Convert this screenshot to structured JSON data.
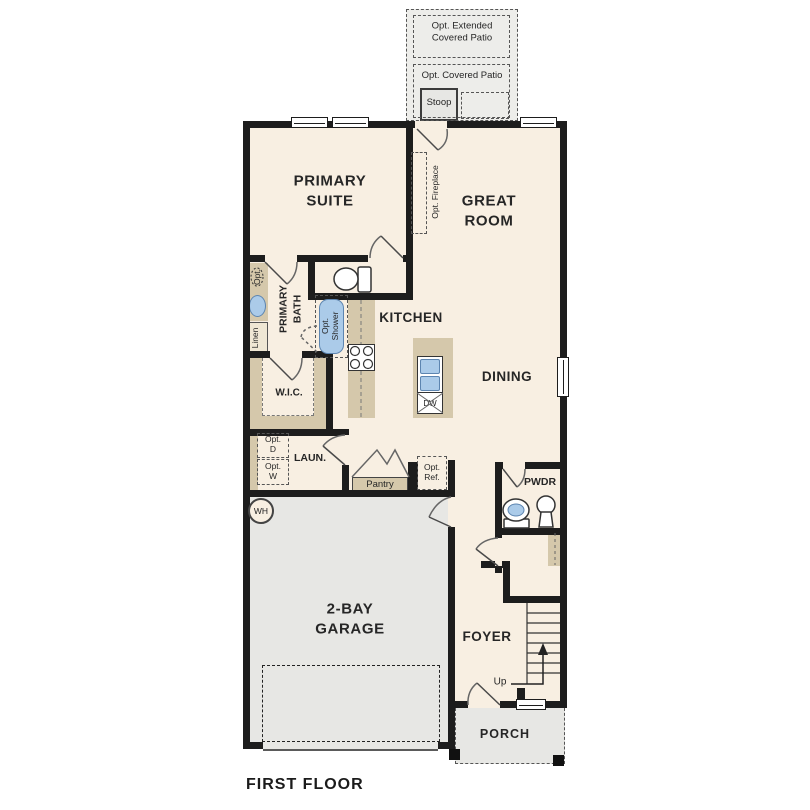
{
  "plan": {
    "title": "FIRST FLOOR",
    "colors": {
      "room_fill": "#f8efe2",
      "garage_fill": "#e7e7e4",
      "patio_fill": "#ededea",
      "cabinet_fill": "#d5c8ab",
      "fixture_blue": "#abcbe9",
      "fixture_blue_border": "#5d85b0",
      "wall": "#1d1d1d",
      "text": "#222222"
    },
    "labels": {
      "opt_extended_patio": "Opt. Extended\nCovered Patio",
      "opt_covered_patio": "Opt. Covered Patio",
      "stoop": "Stoop",
      "primary_suite": "PRIMARY\nSUITE",
      "great_room": "GREAT\nROOM",
      "opt_fireplace": "Opt. Fireplace",
      "primary_bath": "PRIMARY\nBATH",
      "opt_sink": "Opt.",
      "linen": "Linen",
      "opt_shower": "Opt.\nShower",
      "kitchen": "KITCHEN",
      "dining": "DINING",
      "dishwasher": "DW",
      "wic": "W.I.C.",
      "laundry": "LAUN.",
      "opt_dryer": "Opt.\nD",
      "opt_washer": "Opt.\nW",
      "pantry": "Pantry",
      "opt_ref": "Opt.\nRef.",
      "pwdr": "PWDR",
      "water_heater": "WH",
      "garage": "2-BAY\nGARAGE",
      "foyer": "FOYER",
      "up": "Up",
      "porch": "PORCH"
    }
  }
}
